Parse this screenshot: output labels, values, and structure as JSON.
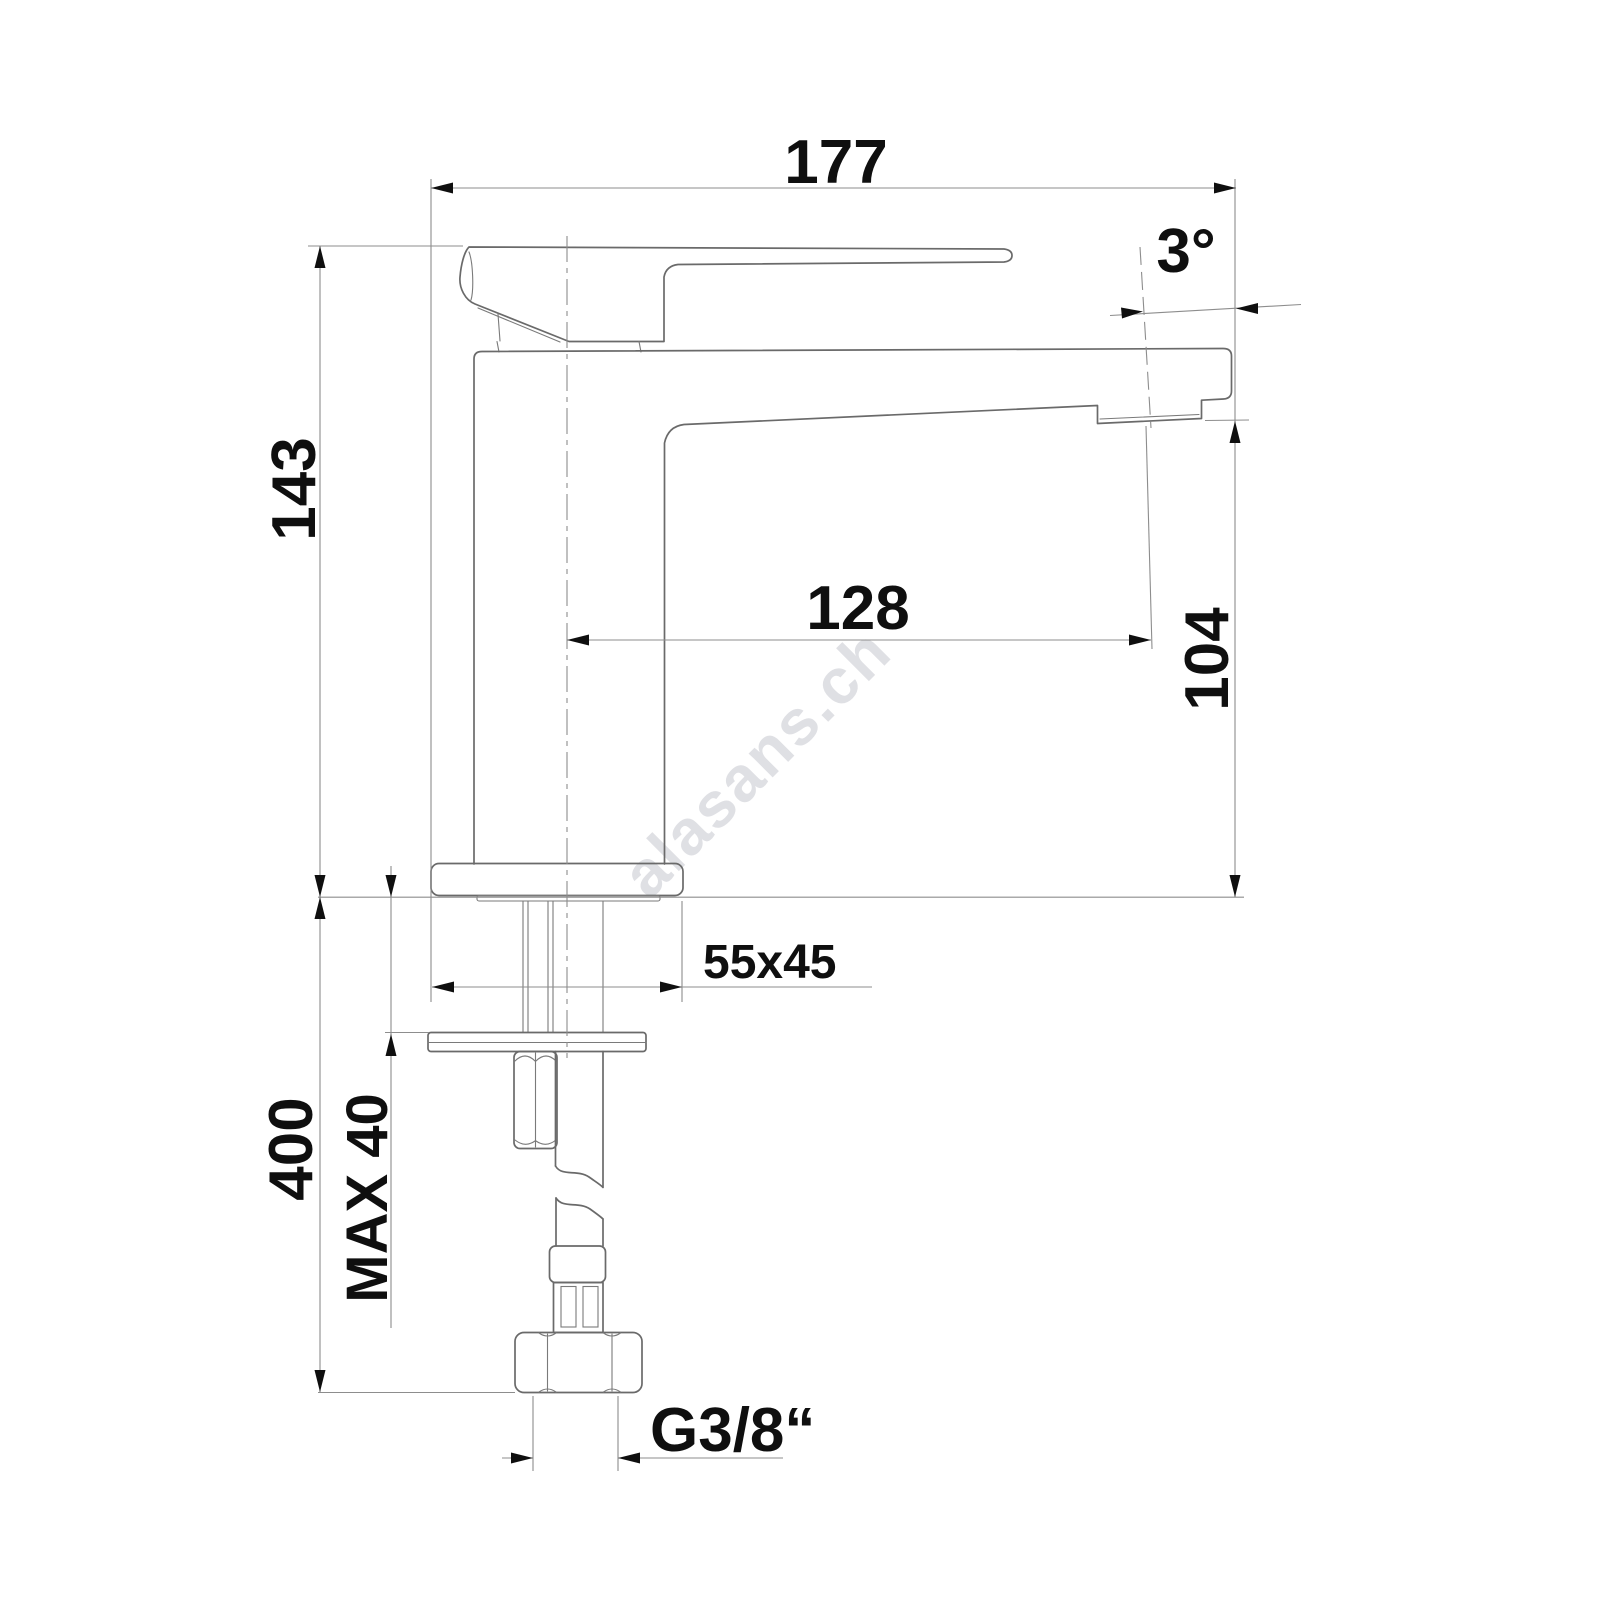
{
  "drawing": {
    "kind": "faucet-dimension-drawing",
    "dimensions": {
      "overall_length": "177",
      "total_height": "143",
      "spout_reach": "128",
      "spout_height": "104",
      "spout_angle": "3°",
      "base_plate": "55x45",
      "hose_length": "400",
      "max_mounting_thickness": "MAX 40",
      "connection_thread": "G3/8“"
    },
    "watermark": "alasans.ch",
    "colors": {
      "outline": "#6a6a6a",
      "dimension_lines": "#8d8d8d",
      "text": "#0f0f0f",
      "watermark": "#c6c7cf",
      "background": "#ffffff"
    }
  }
}
